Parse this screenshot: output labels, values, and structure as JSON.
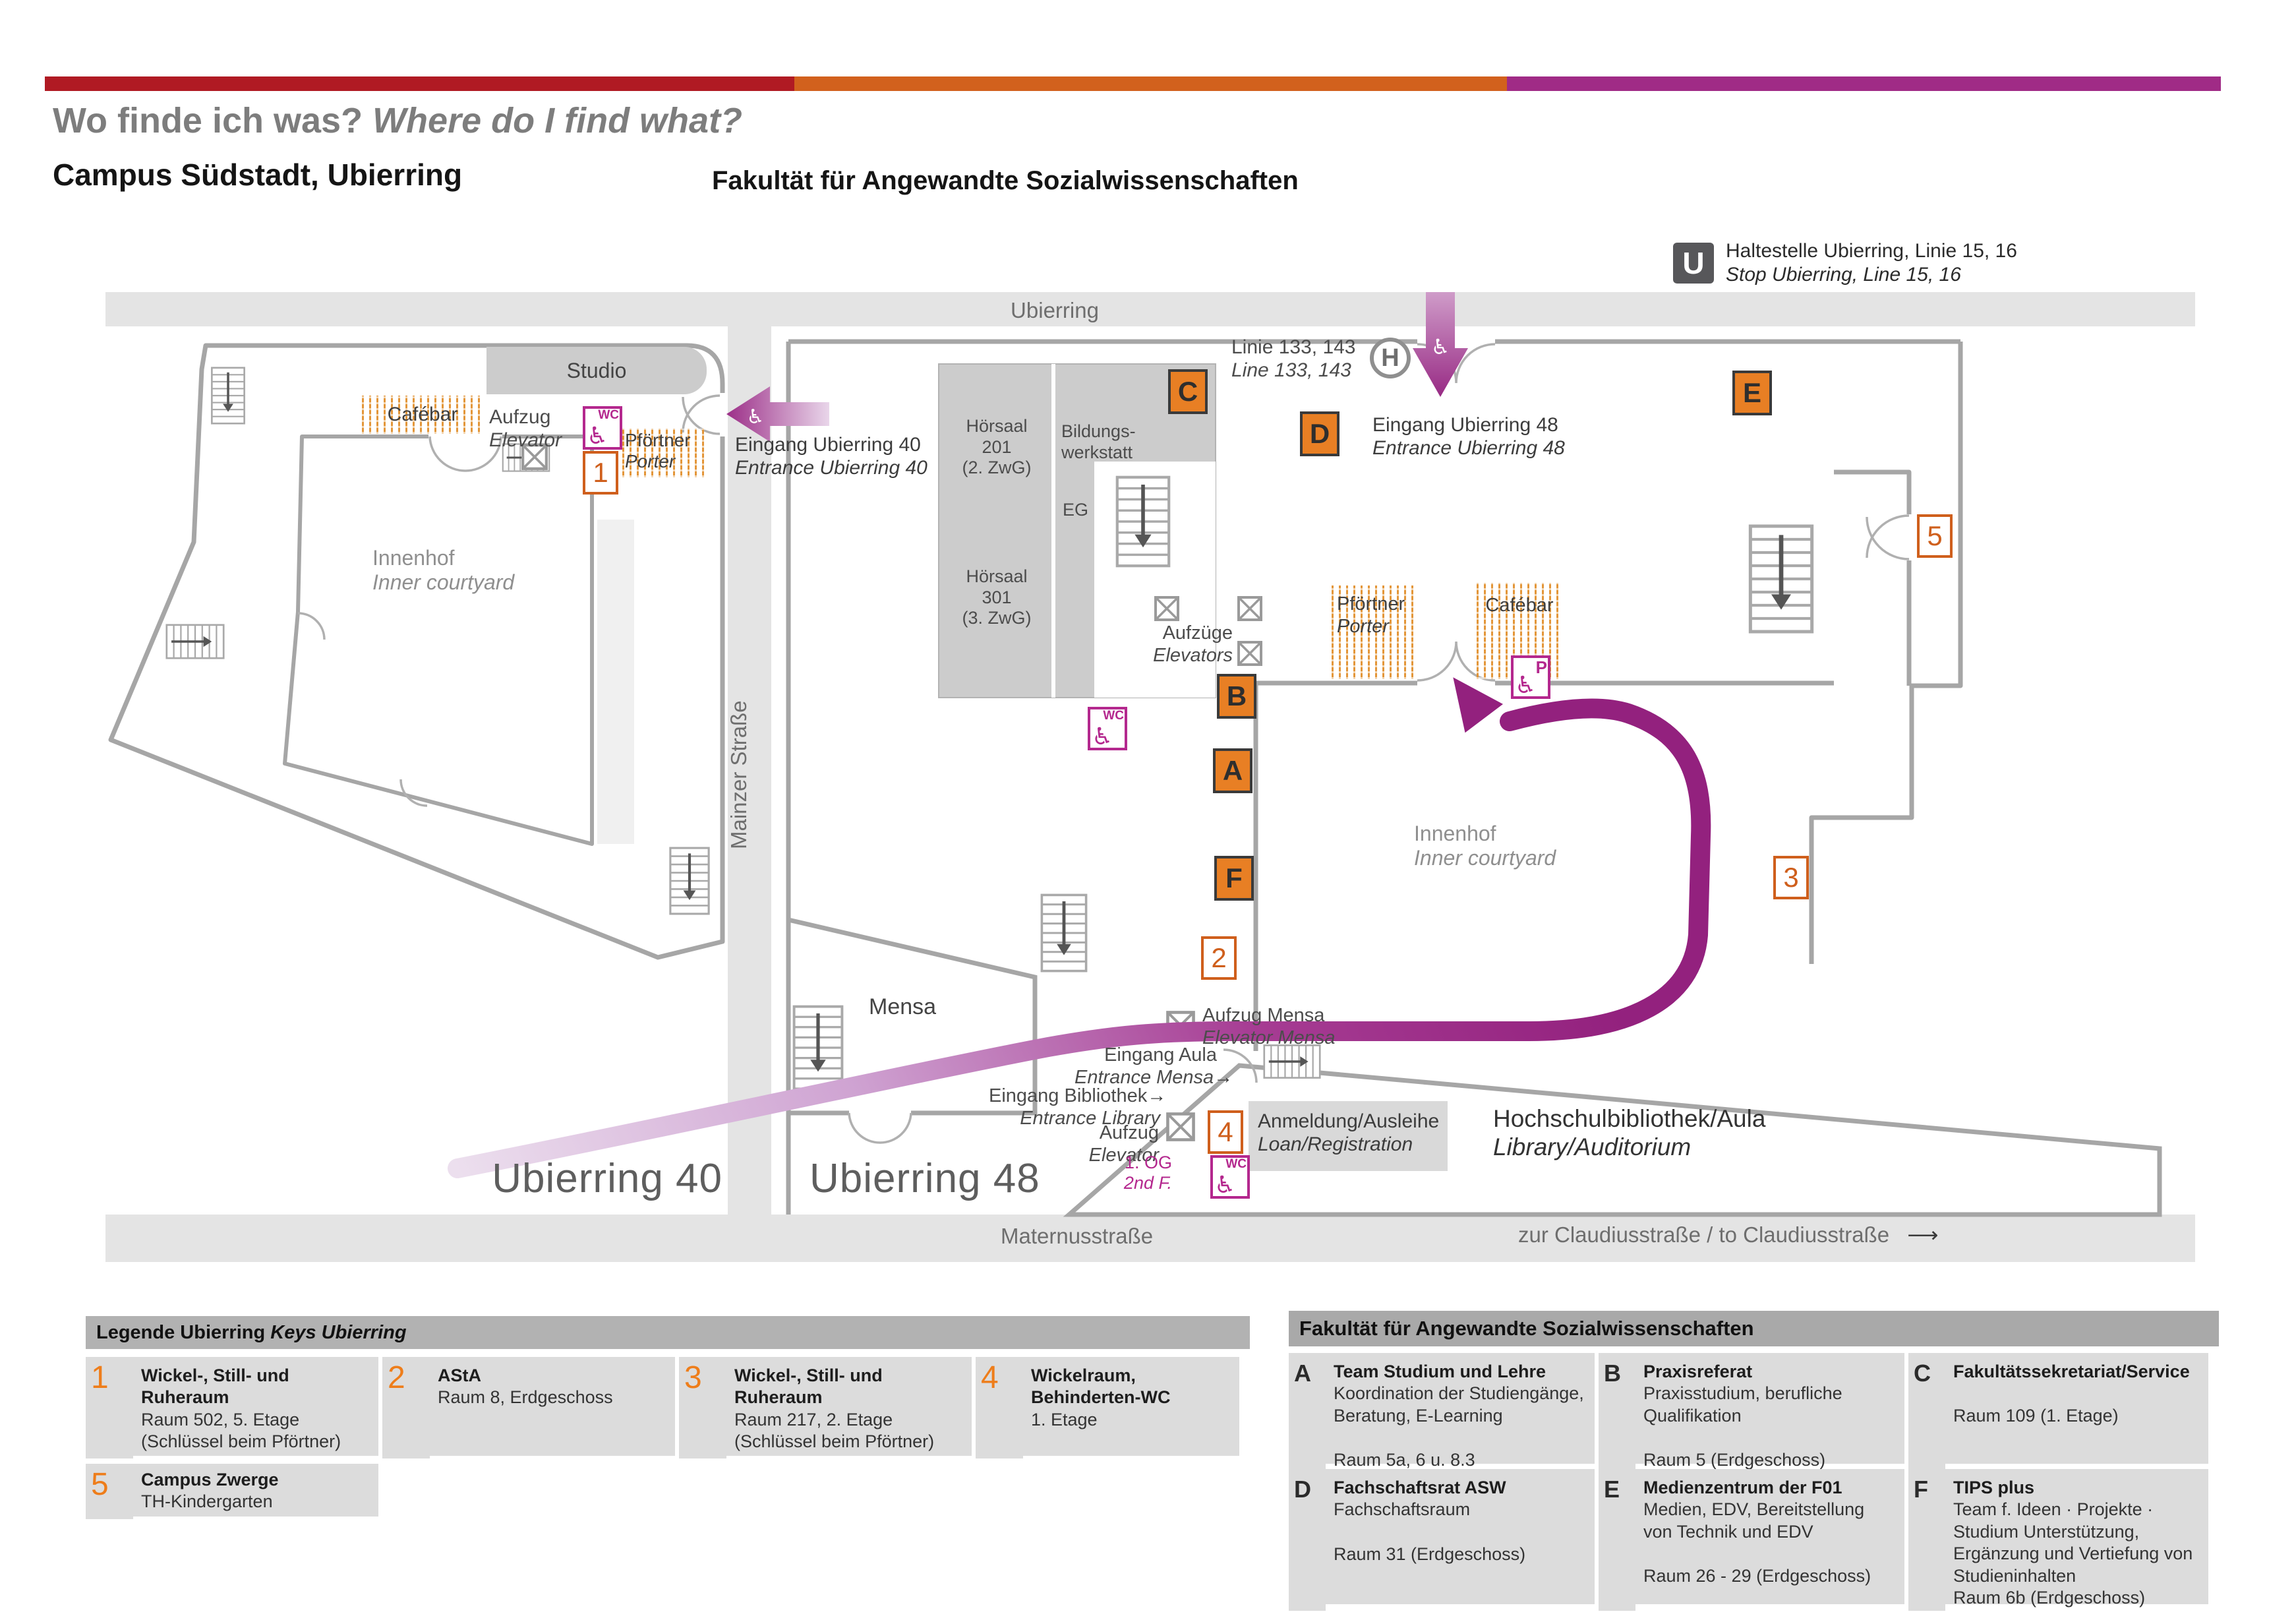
{
  "header": {
    "title_de": "Wo finde ich was?",
    "title_en": "Where do I find what?",
    "subtitle": "Campus Südstadt, Ubierring"
  },
  "transit": {
    "u_symbol": "U",
    "stop_de": "Haltestelle Ubierring, Linie 15, 16",
    "stop_en": "Stop Ubierring, Line 15, 16",
    "bus_de": "Linie 133, 143",
    "bus_en": "Line 133, 143",
    "h_symbol": "H"
  },
  "streets": {
    "ubierring": "Ubierring",
    "mainzer": "Mainzer Straße",
    "maternus": "Maternusstraße",
    "claudius": "zur Claudiusstraße / to Claudiusstraße"
  },
  "icons": {
    "wheelchair": "♿",
    "arrow_small": "→",
    "arrow_long": "⟶"
  },
  "u40": {
    "label": "Ubierring 40",
    "studio": "Studio",
    "cafebar": "Cafébar",
    "aufzug_de": "Aufzug",
    "aufzug_en": "Elevator",
    "wc": "WC",
    "porter_de": "Pförtner",
    "porter_en": "Porter",
    "entrance_de": "Eingang Ubierring 40",
    "entrance_en": "Entrance Ubierring 40",
    "courtyard_de": "Innenhof",
    "courtyard_en": "Inner courtyard"
  },
  "u48": {
    "label": "Ubierring 48",
    "hoersaal_201": "Hörsaal\n201\n(2. ZwG)",
    "hoersaal_301": "Hörsaal\n301\n(3. ZwG)",
    "bildungswerkstatt": "Bildungs-\nwerkstatt",
    "eg": "EG",
    "entrance_de": "Eingang Ubierring 48",
    "entrance_en": "Entrance Ubierring 48",
    "elevators_de": "Aufzüge",
    "elevators_en": "Elevators",
    "porter_de": "Pförtner",
    "porter_en": "Porter",
    "cafebar": "Cafébar",
    "p_symbol": "P",
    "wc": "WC",
    "courtyard_de": "Innenhof",
    "courtyard_en": "Inner courtyard",
    "mensa": "Mensa",
    "aufzug_mensa_de": "Aufzug Mensa",
    "aufzug_mensa_en": "Elevator Mensa",
    "eingang_aula_de": "Eingang Aula",
    "eingang_aula_en": "Entrance Mensa",
    "eingang_bib_de": "Eingang Bibliothek",
    "eingang_bib_en": "Entrance Library",
    "aufzug_bib_de": "Aufzug",
    "aufzug_bib_en": "Elevator",
    "floor_de": "1. OG",
    "floor_en": "2nd F.",
    "anmeldung_de": "Anmeldung/Ausleihe",
    "anmeldung_en": "Loan/Registration",
    "bibliothek_de": "Hochschulbibliothek/Aula",
    "bibliothek_en": "Library/Auditorium"
  },
  "markers": {
    "a": "A",
    "b": "B",
    "c": "C",
    "d": "D",
    "e": "E",
    "f": "F",
    "n1": "1",
    "n2": "2",
    "n3": "3",
    "n4": "4",
    "n5": "5"
  },
  "legend": {
    "heading_de": "Legende Ubierring",
    "heading_en": "Keys Ubierring",
    "items": [
      {
        "key": "1",
        "title": "Wickel-, Still- und Ruheraum",
        "line1": "Raum 502, 5. Etage",
        "line2": "(Schlüssel beim Pförtner)"
      },
      {
        "key": "2",
        "title": "AStA",
        "line1": "Raum 8, Erdgeschoss",
        "line2": ""
      },
      {
        "key": "3",
        "title": "Wickel-, Still- und Ruheraum",
        "line1": "Raum 217, 2. Etage",
        "line2": "(Schlüssel beim Pförtner)"
      },
      {
        "key": "4",
        "title": "Wickelraum, Behinderten-WC",
        "line1": "1. Etage",
        "line2": ""
      },
      {
        "key": "5",
        "title": "Campus Zwerge",
        "line1": "TH-Kindergarten",
        "line2": ""
      }
    ]
  },
  "faculty": {
    "heading": "Fakultät für Angewandte Sozialwissenschaften",
    "items": [
      {
        "key": "A",
        "title": "Team Studium und Lehre",
        "desc": "Koordination der Studiengänge, Beratung, E-Learning",
        "room": "Raum 5a, 6 u. 8.3 (Erdgeschoss)"
      },
      {
        "key": "B",
        "title": "Praxisreferat",
        "desc": "Praxisstudium, berufliche Qualifikation",
        "room": "Raum 5 (Erdgeschoss)"
      },
      {
        "key": "C",
        "title": "Fakultätssekretariat/Service",
        "desc": "",
        "room": "Raum 109 (1. Etage)"
      },
      {
        "key": "D",
        "title": "Fachschaftsrat ASW",
        "desc": "Fachschaftsraum",
        "room": "Raum 31 (Erdgeschoss)"
      },
      {
        "key": "E",
        "title": "Medienzentrum der F01",
        "desc": "Medien, EDV, Bereitstellung von Technik und EDV",
        "room": "Raum 26 - 29 (Erdgeschoss)"
      },
      {
        "key": "F",
        "title": "TIPS plus",
        "desc": "Team f. Ideen · Projekte · Studium Unterstützung, Ergänzung und Vertiefung von Studieninhalten",
        "room": "Raum 6b (Erdgeschoss)"
      }
    ]
  },
  "colors": {
    "bar_red": "#b01a23",
    "bar_orange": "#d2611d",
    "bar_purple": "#a02b86",
    "marker_orange": "#e87f24",
    "magenta": "#b4288e",
    "path_purple": "#9b2b86"
  }
}
